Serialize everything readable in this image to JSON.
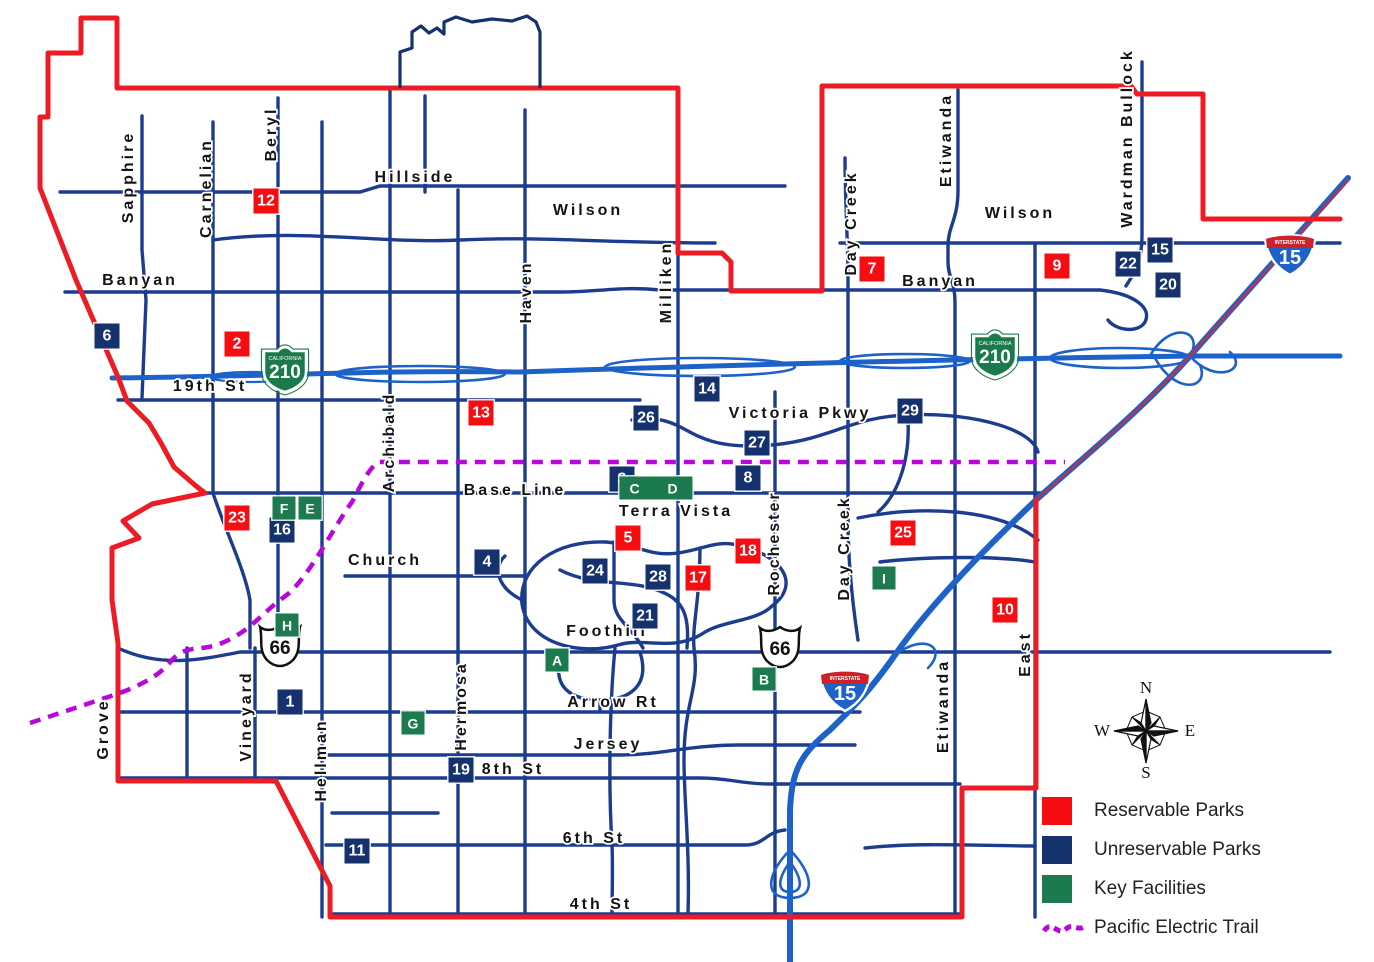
{
  "map_title": "City Parks and Facilities Map",
  "colors": {
    "boundary_red": "#ED1C24",
    "road_navy": "#1B3C8F",
    "freeway_blue": "#1C62C8",
    "trail_purple": "#B806DC",
    "marker_red": "#F60D12",
    "marker_navy": "#15316E",
    "marker_green": "#1B7B4F"
  },
  "streets": [
    {
      "name": "Sapphire",
      "x": 129,
      "y": 177,
      "v": true
    },
    {
      "name": "Carnelian",
      "x": 207,
      "y": 188,
      "v": true
    },
    {
      "name": "Beryl",
      "x": 272,
      "y": 134,
      "v": true
    },
    {
      "name": "Hillside",
      "x": 415,
      "y": 178,
      "v": false
    },
    {
      "name": "Wilson",
      "x": 588,
      "y": 211,
      "v": false
    },
    {
      "name": "Wilson",
      "x": 1020,
      "y": 214,
      "v": false
    },
    {
      "name": "Banyan",
      "x": 140,
      "y": 281,
      "v": false
    },
    {
      "name": "Banyan",
      "x": 940,
      "y": 282,
      "v": false
    },
    {
      "name": "19th St",
      "x": 210,
      "y": 387,
      "v": false
    },
    {
      "name": "Haven",
      "x": 527,
      "y": 292,
      "v": true
    },
    {
      "name": "Milliken",
      "x": 667,
      "y": 282,
      "v": true
    },
    {
      "name": "Day Creek",
      "x": 852,
      "y": 223,
      "v": true
    },
    {
      "name": "Etiwanda",
      "x": 947,
      "y": 140,
      "v": true
    },
    {
      "name": "Wardman Bullock",
      "x": 1128,
      "y": 138,
      "v": true
    },
    {
      "name": "Victoria Pkwy",
      "x": 800,
      "y": 414,
      "v": false
    },
    {
      "name": "Archibald",
      "x": 390,
      "y": 442,
      "v": true
    },
    {
      "name": "Base Line",
      "x": 515,
      "y": 491,
      "v": false
    },
    {
      "name": "Terra Vista",
      "x": 676,
      "y": 512,
      "v": false
    },
    {
      "name": "Church",
      "x": 385,
      "y": 561,
      "v": false
    },
    {
      "name": "Rochester",
      "x": 775,
      "y": 543,
      "v": true
    },
    {
      "name": "Day Creek",
      "x": 845,
      "y": 548,
      "v": true
    },
    {
      "name": "Foothill",
      "x": 607,
      "y": 632,
      "v": false
    },
    {
      "name": "Arrow Rt",
      "x": 613,
      "y": 703,
      "v": false
    },
    {
      "name": "Jersey",
      "x": 608,
      "y": 745,
      "v": false
    },
    {
      "name": "8th St",
      "x": 513,
      "y": 770,
      "v": false
    },
    {
      "name": "6th St",
      "x": 594,
      "y": 839,
      "v": false
    },
    {
      "name": "4th St",
      "x": 601,
      "y": 905,
      "v": false
    },
    {
      "name": "Hermosa",
      "x": 462,
      "y": 706,
      "v": true
    },
    {
      "name": "Hellman",
      "x": 322,
      "y": 760,
      "v": true
    },
    {
      "name": "Vineyard",
      "x": 247,
      "y": 716,
      "v": true
    },
    {
      "name": "Grove",
      "x": 104,
      "y": 729,
      "v": true
    },
    {
      "name": "East",
      "x": 1026,
      "y": 654,
      "v": true
    },
    {
      "name": "Etiwanda",
      "x": 944,
      "y": 706,
      "v": true
    }
  ],
  "shields": [
    {
      "type": "ca",
      "label": "210",
      "sub": "CALIFORNIA",
      "x": 285,
      "y": 367
    },
    {
      "type": "ca",
      "label": "210",
      "sub": "CALIFORNIA",
      "x": 995,
      "y": 352
    },
    {
      "type": "us",
      "label": "66",
      "x": 280,
      "y": 647
    },
    {
      "type": "us",
      "label": "66",
      "x": 780,
      "y": 648
    },
    {
      "type": "i15",
      "label": "15",
      "sub": "INTERSTATE",
      "x": 1290,
      "y": 252
    },
    {
      "type": "i15",
      "label": "15",
      "sub": "INTERSTATE",
      "x": 845,
      "y": 688
    }
  ],
  "markers": [
    {
      "label": "12",
      "type": "reservable",
      "x": 266,
      "y": 201
    },
    {
      "label": "2",
      "type": "reservable",
      "x": 237,
      "y": 344
    },
    {
      "label": "7",
      "type": "reservable",
      "x": 872,
      "y": 269
    },
    {
      "label": "9",
      "type": "reservable",
      "x": 1057,
      "y": 266
    },
    {
      "label": "13",
      "type": "reservable",
      "x": 481,
      "y": 413
    },
    {
      "label": "23",
      "type": "reservable",
      "x": 237,
      "y": 518
    },
    {
      "label": "5",
      "type": "reservable",
      "x": 628,
      "y": 538
    },
    {
      "label": "18",
      "type": "reservable",
      "x": 748,
      "y": 551
    },
    {
      "label": "17",
      "type": "reservable",
      "x": 698,
      "y": 578
    },
    {
      "label": "25",
      "type": "reservable",
      "x": 903,
      "y": 533
    },
    {
      "label": "10",
      "type": "reservable",
      "x": 1005,
      "y": 610
    },
    {
      "label": "6",
      "type": "unreservable",
      "x": 107,
      "y": 336
    },
    {
      "label": "15",
      "type": "unreservable",
      "x": 1160,
      "y": 250
    },
    {
      "label": "22",
      "type": "unreservable",
      "x": 1128,
      "y": 264
    },
    {
      "label": "20",
      "type": "unreservable",
      "x": 1168,
      "y": 285
    },
    {
      "label": "14",
      "type": "unreservable",
      "x": 707,
      "y": 389
    },
    {
      "label": "26",
      "type": "unreservable",
      "x": 646,
      "y": 418
    },
    {
      "label": "27",
      "type": "unreservable",
      "x": 757,
      "y": 443
    },
    {
      "label": "29",
      "type": "unreservable",
      "x": 910,
      "y": 411
    },
    {
      "label": "3",
      "type": "unreservable",
      "x": 622,
      "y": 479
    },
    {
      "label": "8",
      "type": "unreservable",
      "x": 748,
      "y": 478
    },
    {
      "label": "16",
      "type": "unreservable",
      "x": 282,
      "y": 530
    },
    {
      "label": "4",
      "type": "unreservable",
      "x": 487,
      "y": 562
    },
    {
      "label": "24",
      "type": "unreservable",
      "x": 595,
      "y": 571
    },
    {
      "label": "28",
      "type": "unreservable",
      "x": 658,
      "y": 577
    },
    {
      "label": "21",
      "type": "unreservable",
      "x": 645,
      "y": 616
    },
    {
      "label": "1",
      "type": "unreservable",
      "x": 290,
      "y": 702
    },
    {
      "label": "19",
      "type": "unreservable",
      "x": 461,
      "y": 770
    },
    {
      "label": "11",
      "type": "unreservable",
      "x": 357,
      "y": 851
    },
    {
      "label": "F",
      "type": "facility",
      "x": 284,
      "y": 508
    },
    {
      "label": "E",
      "type": "facility",
      "x": 310,
      "y": 508
    },
    {
      "label": "C D",
      "type": "facility",
      "wide": true,
      "x": 656,
      "y": 488
    },
    {
      "label": "H",
      "type": "facility",
      "x": 287,
      "y": 625
    },
    {
      "label": "A",
      "type": "facility",
      "x": 557,
      "y": 660
    },
    {
      "label": "G",
      "type": "facility",
      "x": 413,
      "y": 723
    },
    {
      "label": "B",
      "type": "facility",
      "x": 764,
      "y": 679
    },
    {
      "label": "I",
      "type": "facility",
      "x": 884,
      "y": 578
    }
  ],
  "legend": {
    "items": [
      {
        "label": "Reservable Parks",
        "color": "#F60D12"
      },
      {
        "label": "Unreservable Parks",
        "color": "#15316E"
      },
      {
        "label": "Key Facilities",
        "color": "#1B7B4F"
      },
      {
        "label": "Pacific Electric Trail",
        "color": "#B806DC"
      }
    ]
  },
  "compass": {
    "n": "N",
    "e": "E",
    "s": "S",
    "w": "W"
  }
}
